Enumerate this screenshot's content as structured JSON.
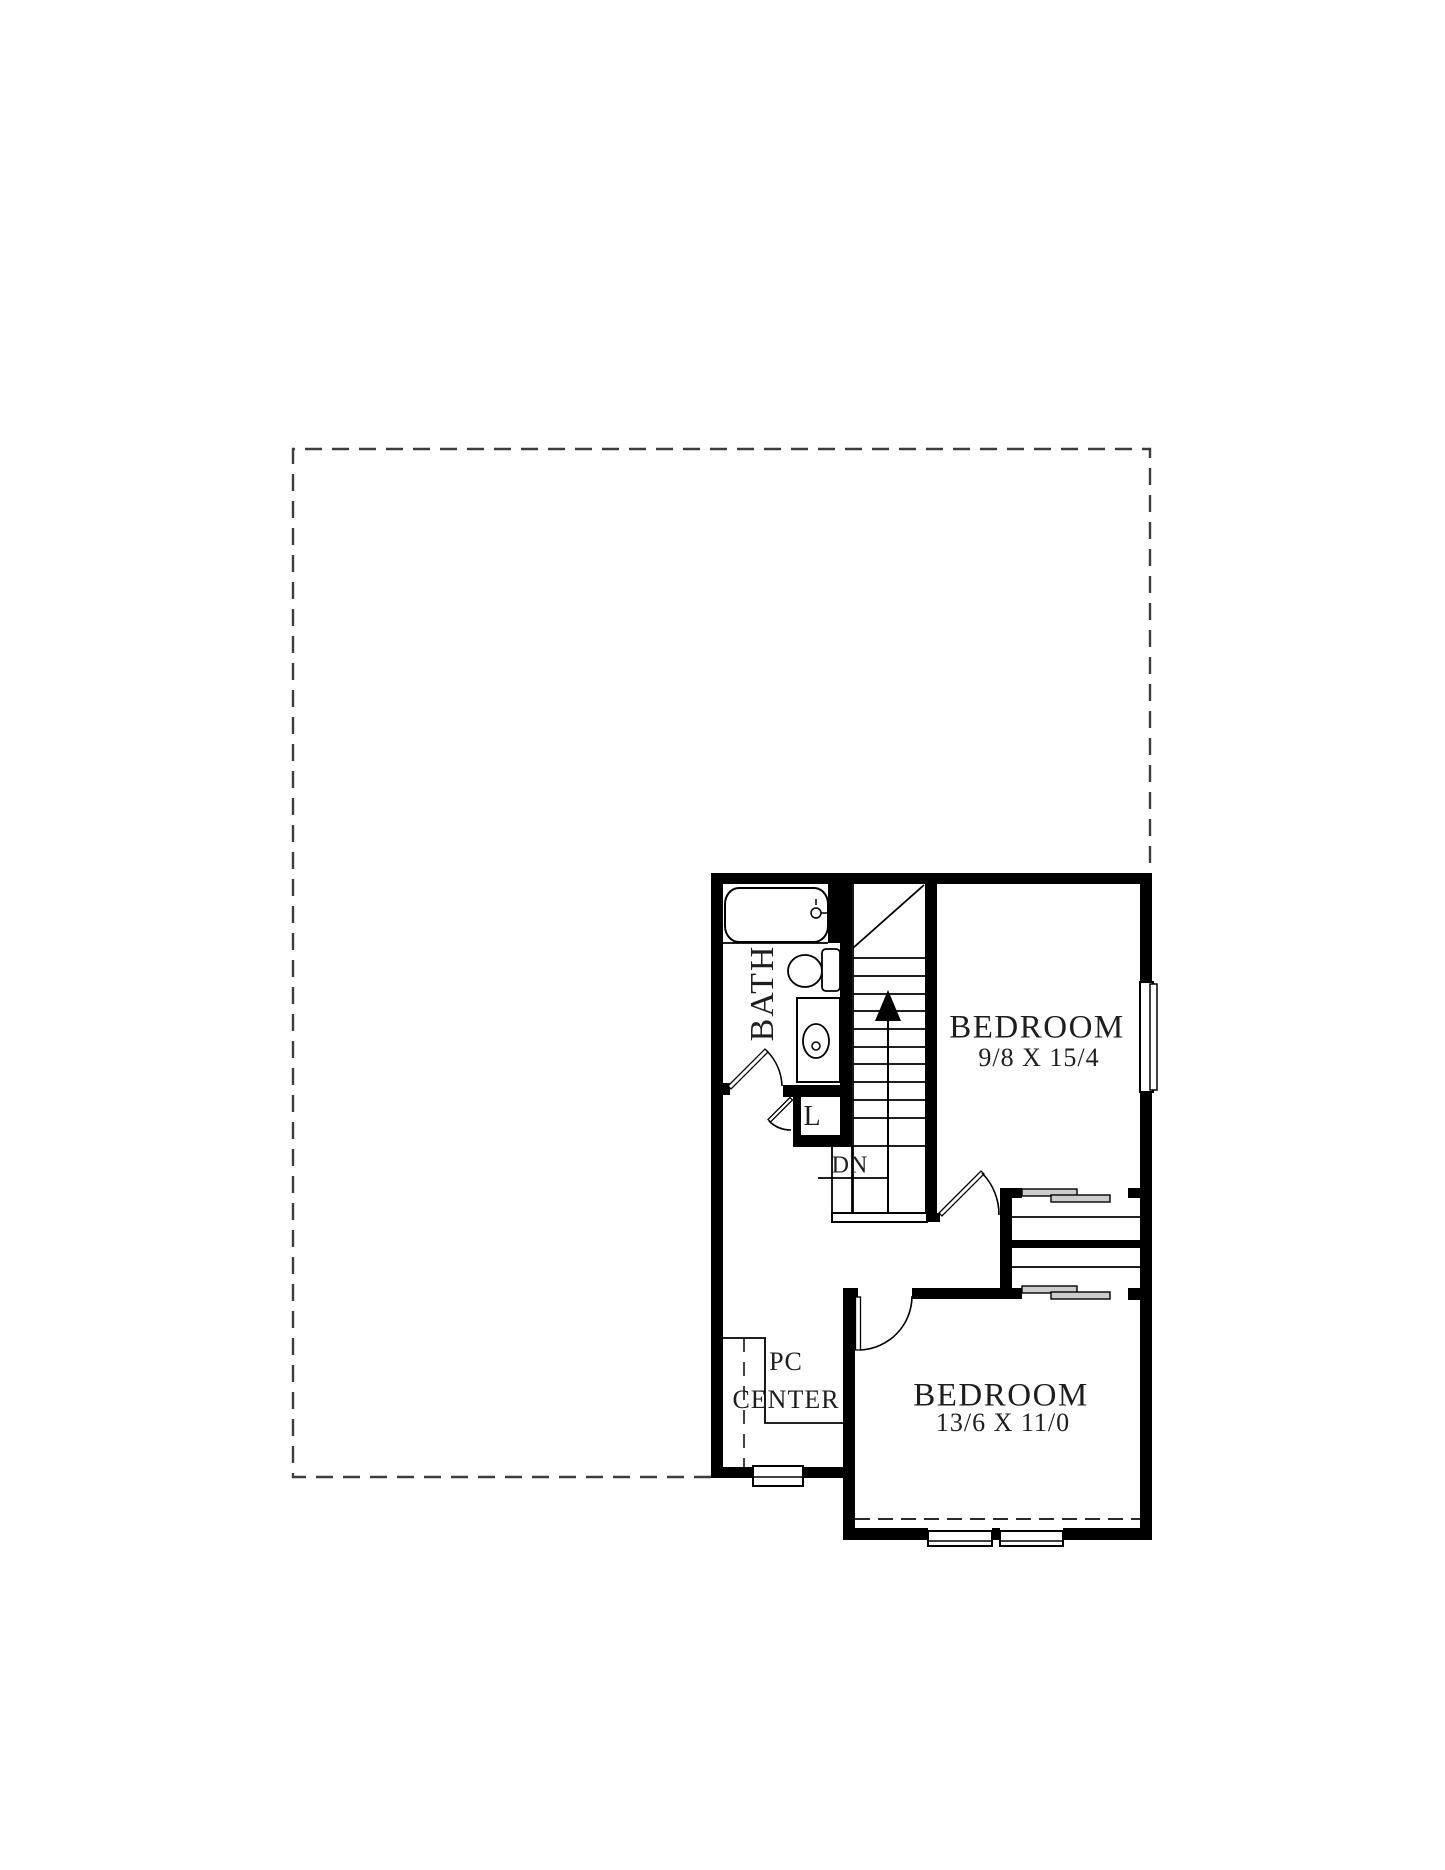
{
  "document": {
    "type": "second-floor-plan"
  },
  "labels": {
    "bath": "BATH",
    "linen_closet": "L",
    "stair_direction": "DN",
    "bedroom1": {
      "name": "BEDROOM",
      "dimensions": "9/8 X 15/4"
    },
    "bedroom2": {
      "name": "BEDROOM",
      "dimensions": "13/6 X 11/0"
    },
    "pc_center_line1": "PC",
    "pc_center_line2": "CENTER"
  },
  "colors": {
    "background": "#ffffff",
    "wall": "#000000",
    "line": "#1a1a1a",
    "dashed_outline": "#3d3d3d",
    "text": "#1e1e1e",
    "sliding_door_fill": "#cccccc"
  }
}
